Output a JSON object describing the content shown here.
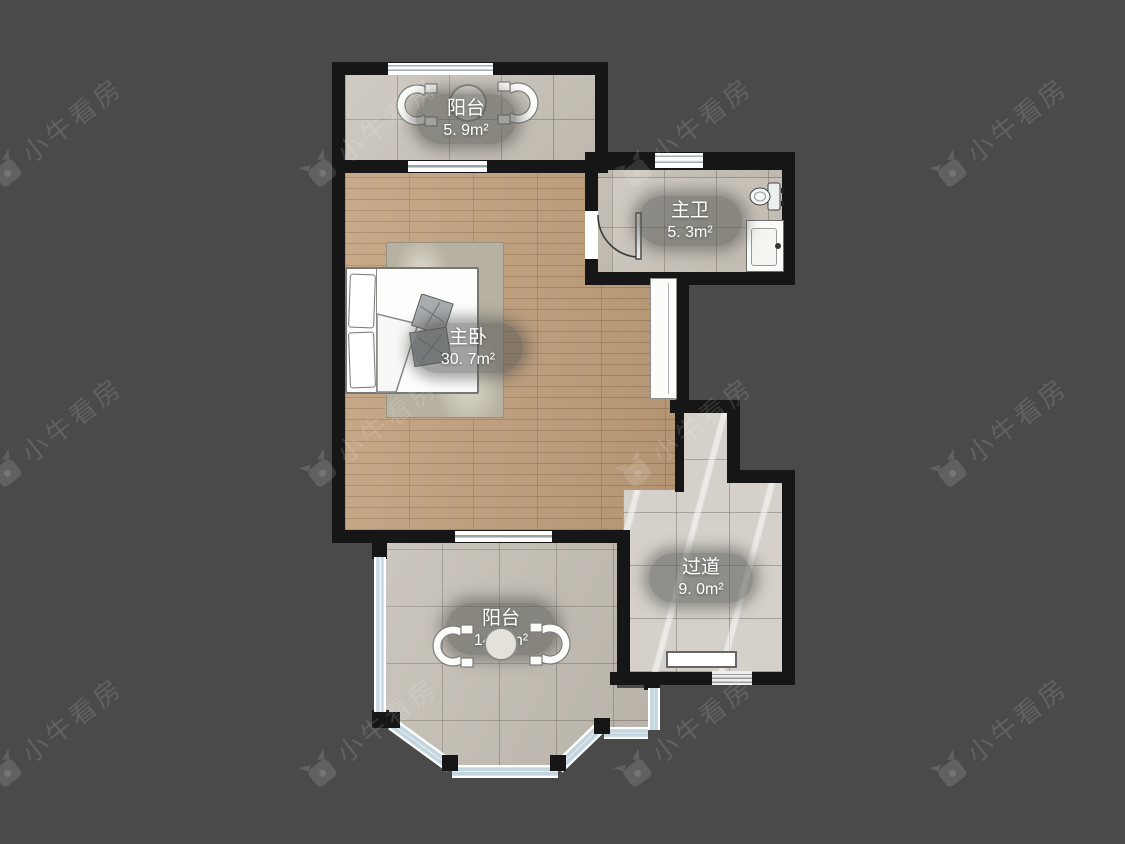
{
  "watermark": {
    "brand": "小牛看房"
  },
  "floorplan": {
    "rooms": [
      {
        "id": "balcony-top",
        "name": "阳台",
        "area": "5. 9m²"
      },
      {
        "id": "master-bathroom",
        "name": "主卫",
        "area": "5. 3m²"
      },
      {
        "id": "master-bedroom",
        "name": "主卧",
        "area": "30. 7m²"
      },
      {
        "id": "hallway",
        "name": "过道",
        "area": "9. 0m²"
      },
      {
        "id": "balcony-bottom",
        "name": "阳台",
        "area": "14. 4m²"
      }
    ],
    "colors": {
      "background": "#4a4a4a",
      "wall": "#161616",
      "wood_floor": "#c2a07c",
      "tile_floor": "#c9c3b9",
      "marble_floor": "#d5d1ca",
      "window_pane": "#c9dbe4",
      "label_bg": "rgba(88,88,84,0.55)",
      "label_text": "#ffffff"
    }
  }
}
